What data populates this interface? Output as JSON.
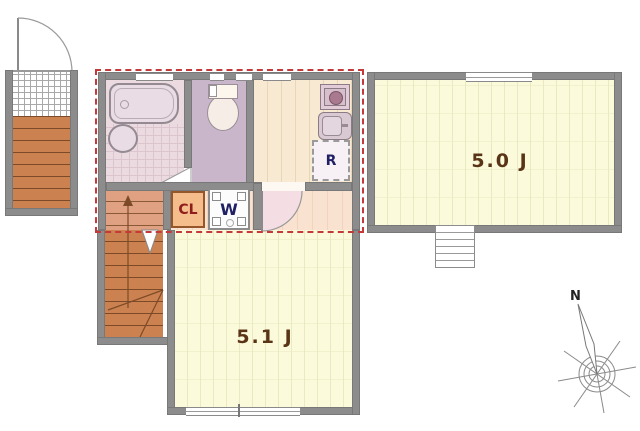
{
  "floor_plan": {
    "rooms": {
      "western_room_a": {
        "label": "5.0 J"
      },
      "western_room_b": {
        "label": "5.1 J"
      },
      "closet": {
        "label": "CL"
      },
      "washer_space": {
        "label": "W"
      },
      "refrigerator_space": {
        "label": "R"
      }
    },
    "compass": {
      "north": "N"
    },
    "colors": {
      "wall": "#8c8c8c",
      "unit_outline_dashed": "#c43a3a",
      "wood_floor": "#fbfbdc",
      "kitchen_floor": "#f8e9d2",
      "hallway_floor": "#f9e2cf",
      "bathroom_floor": "#ecdae1",
      "toilet_floor": "#c9b6cb",
      "stairs": "#cb8150",
      "closet_fill": "#f6bd8c",
      "room_label_text": "#5a3416",
      "appliance_label_text": "#202064",
      "closet_label_text": "#8e1d1d"
    }
  }
}
